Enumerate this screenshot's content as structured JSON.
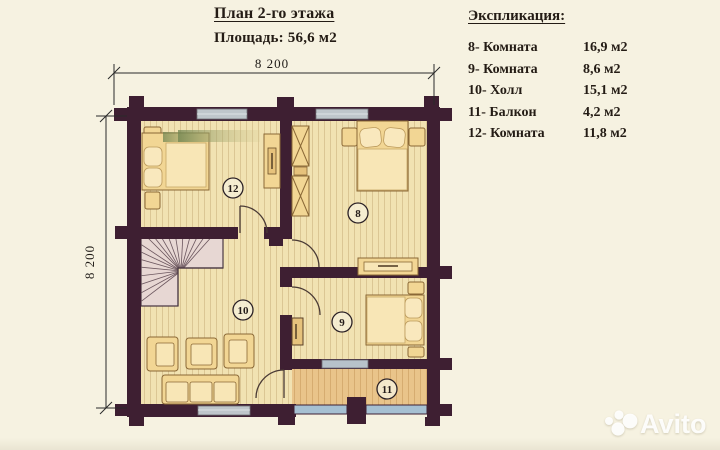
{
  "title": {
    "heading": "План 2-го этажа",
    "area": "Площадь: 56,6 м2"
  },
  "legend": {
    "heading": "Экспликация:",
    "rows": [
      {
        "label": "8- Комната",
        "area": "16,9 м2"
      },
      {
        "label": "9- Комната",
        "area": "8,6 м2"
      },
      {
        "label": "10- Холл",
        "area": "15,1 м2"
      },
      {
        "label": "11- Балкон",
        "area": "4,2 м2"
      },
      {
        "label": "12- Комната",
        "area": "11,8 м2"
      }
    ]
  },
  "dimensions": {
    "width": "8 200",
    "height": "8 200"
  },
  "rooms": {
    "r8": "8",
    "r9": "9",
    "r10": "10",
    "r11": "11",
    "r12": "12"
  },
  "watermark": {
    "text": "Avito"
  },
  "colors": {
    "background": "#f6f2e1",
    "wall": "#3e1f32",
    "floor": "#f1e2b2",
    "floor_stripe": "#c9ae7c",
    "balcony_floor": "#e9c48a",
    "balcony_stripe": "#c99c5e",
    "stairs": "#e7d7d3",
    "window": "#b7bec4",
    "railing": "#a6c0d2",
    "furniture": "#f2d694",
    "furniture_border": "#8a6836",
    "text": "#241c15",
    "watermark_text": "#ffffff"
  }
}
